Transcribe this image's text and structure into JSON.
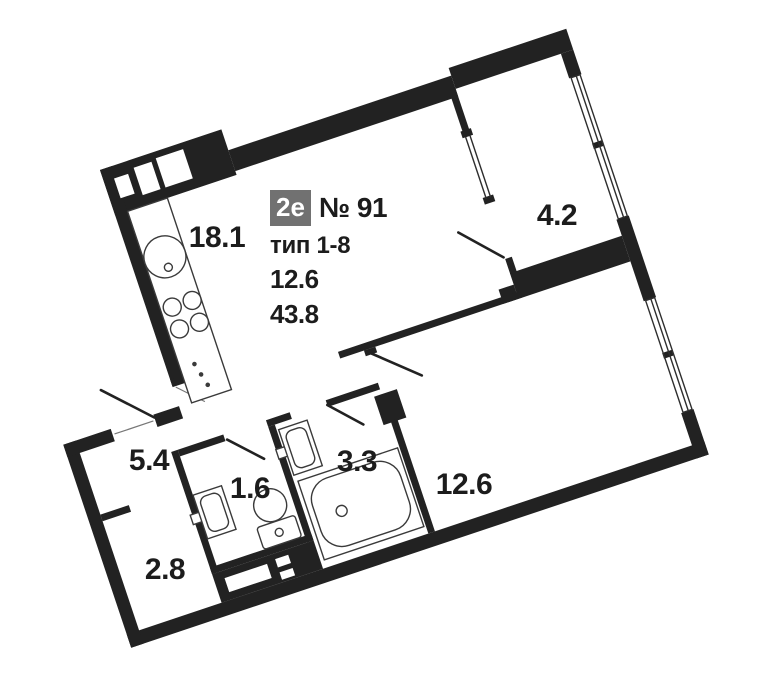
{
  "unit_card": {
    "type_badge": "2е",
    "number": "№ 91",
    "plan_type": "тип 1-8",
    "living_area": "12.6",
    "total_area": "43.8"
  },
  "room_labels": [
    {
      "name": "kitchen-living-room",
      "area": "18.1",
      "x": 217,
      "y": 238
    },
    {
      "name": "balcony",
      "area": "4.2",
      "x": 557,
      "y": 216
    },
    {
      "name": "bedroom",
      "area": "12.6",
      "x": 464,
      "y": 485
    },
    {
      "name": "bathroom",
      "area": "3.3",
      "x": 357,
      "y": 462
    },
    {
      "name": "wc",
      "area": "1.6",
      "x": 250,
      "y": 489
    },
    {
      "name": "hallway",
      "area": "5.4",
      "x": 149,
      "y": 461
    },
    {
      "name": "wardrobe",
      "area": "2.8",
      "x": 165,
      "y": 570
    }
  ],
  "colors": {
    "wall": "#222222",
    "line": "#2e2e2e",
    "fixture_line": "#3a3a3a",
    "badge_bg": "#717171",
    "badge_text": "#ffffff",
    "text": "#1c1c1c"
  }
}
